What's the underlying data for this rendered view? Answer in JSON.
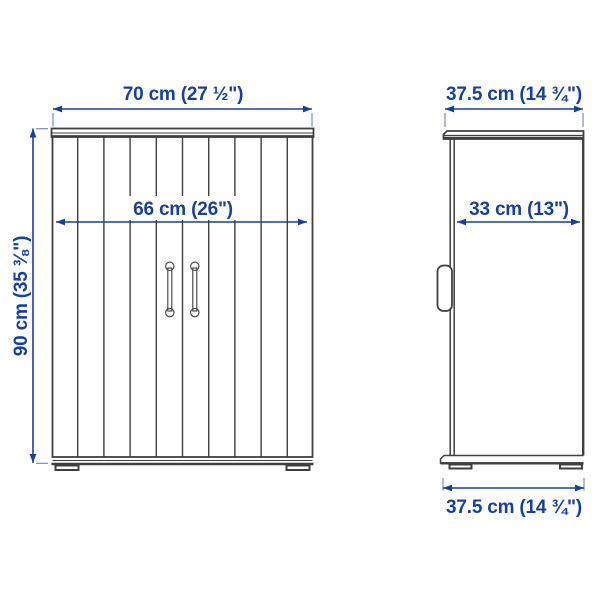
{
  "diagram": {
    "kind": "furniture-dimension-diagram",
    "subject": "two-door cabinet, front view and side view"
  },
  "colors": {
    "dimension_blue": "#17409c",
    "drawing_ink": "#3f3f3f",
    "background": "#ffffff"
  },
  "dims": {
    "front_width": "70 cm (27 ½\")",
    "front_inner_width": "66 cm (26\")",
    "height": "90 cm (35 ⅜\")",
    "side_depth_top": "37.5 cm (14 ¾\")",
    "side_inner_depth": "33 cm (13\")",
    "side_depth_bottom": "37.5 cm (14 ¾\")"
  }
}
